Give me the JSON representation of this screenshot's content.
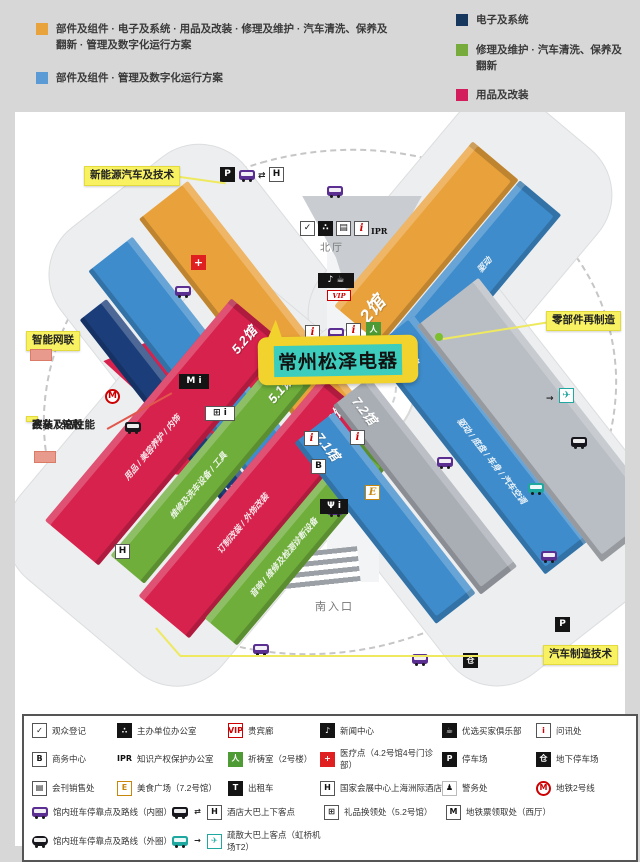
{
  "top_legend": {
    "items": [
      {
        "color": "#E8A33D",
        "text": "部件及组件 · 电子及系统 · 用品及改装 · 修理及维护 · 汽车清洗、保养及翻新 · 管理及数字化运行方案"
      },
      {
        "color": "#5B9BD5",
        "text": "部件及组件 · 管理及数字化运行方案"
      },
      {
        "color": "#17375E",
        "text": "电子及系统"
      },
      {
        "color": "#77AC3C",
        "text": "修理及维护 · 汽车清洗、保养及翻新"
      },
      {
        "color": "#D31C5B",
        "text": "用品及改装"
      }
    ]
  },
  "map": {
    "halls": [
      {
        "label": "4.2馆",
        "color": "#3E8CCB"
      },
      {
        "label": "4.1馆",
        "color": "#1B3E7A"
      },
      {
        "label": "3馆",
        "color": "#E9A23B"
      },
      {
        "label": "2馆",
        "color": "#E9A23B"
      },
      {
        "label": "1馆",
        "color": "#3E8CCB",
        "side": "驱动"
      },
      {
        "label": "5.2馆",
        "color": "#D6224C",
        "side": "用品 / 美容养护 / 内饰"
      },
      {
        "label": "5.1馆",
        "color": "#6FAE3B",
        "side": "维修及洗车设备 / 工具"
      },
      {
        "label": "6.2馆",
        "color": "#D6224C",
        "side": "订制改装 / 外饰改装"
      },
      {
        "label": "6.1馆",
        "color": "#6FAE3B",
        "side": "音响 / 维修及检测诊断设备"
      },
      {
        "label": "7.1馆",
        "color": "#3E8CCB"
      },
      {
        "label": "7.2馆",
        "color": "#A9AEB5"
      },
      {
        "label": "8.1馆",
        "color": "#3E8CCB",
        "side": "驱动 / 底盘 / 车身 / 汽车空调"
      },
      {
        "label": "",
        "color": "#B9BEC4"
      }
    ],
    "areas": {
      "west_hall": "西厅",
      "north_hall": "北厅",
      "south_entrance": "南入口"
    },
    "callouts": {
      "new_energy": "新能源汽车及技术",
      "parts_reman": "零部件再制造",
      "smart_connect": "智能网联",
      "racing_line1": "赛车及高性能",
      "racing_line2": "改装 / 轮毂",
      "manufacturing": "汽车制造技术"
    },
    "highlight": {
      "text": "常州松泽电器",
      "bubble_color": "#F2D22C",
      "text_bg": "#3CCDBD"
    }
  },
  "glyphs": {
    "parking": "P",
    "hotel": "H",
    "swap": "⇄",
    "medical": "+",
    "business": "B",
    "info": "i",
    "ipr": "IPR",
    "vip": "VIP",
    "media": "♪ ☕",
    "registration": "✓",
    "organizer": "∴",
    "directory": "▤",
    "prayer": "人",
    "metro": "M",
    "warehouse": "仓",
    "plane": "✈",
    "food_court": "E",
    "restaurant": "Ψ i",
    "metro_ticket": "M i",
    "gift": "⊞ i",
    "arrow": "→"
  },
  "bottom_legend": {
    "rows": [
      [
        {
          "icon": "reg",
          "label": "观众登记"
        },
        {
          "icon": "org",
          "label": "主办单位办公室"
        },
        {
          "icon": "vip",
          "label": "贵宾廊"
        },
        {
          "icon": "news",
          "label": "新闻中心"
        },
        {
          "icon": "buyers",
          "label": "优选买家俱乐部"
        },
        {
          "icon": "info",
          "label": "问讯处"
        }
      ],
      [
        {
          "icon": "biz",
          "label": "商务中心"
        },
        {
          "icon": "ipr",
          "label": "知识产权保护办公室"
        },
        {
          "icon": "prayer",
          "label": "祈祷室（2号楼）"
        },
        {
          "icon": "medical",
          "label": "医疗点（4.2号馆4号门诊部）"
        },
        {
          "icon": "parking",
          "label": "停车场"
        },
        {
          "icon": "ugparking",
          "label": "地下停车场"
        }
      ],
      [
        {
          "icon": "directory",
          "label": "会刊销售处"
        },
        {
          "icon": "food",
          "label": "美食广场（7.2号馆）"
        },
        {
          "icon": "taxi",
          "label": "出租车"
        },
        {
          "icon": "hotel",
          "label": "国家会展中心上海洲际酒店"
        },
        {
          "icon": "police",
          "label": "警务处"
        },
        {
          "icon": "metro",
          "label": "地铁2号线"
        }
      ],
      [
        {
          "icon": "businner",
          "label": "馆内班车停靠点及路线（内圈）"
        },
        {
          "icon": "hotelshuttle",
          "label": "酒店大巴上下客点"
        },
        {
          "icon": "gift",
          "label": "礼品换领处（5.2号馆）"
        },
        {
          "icon": "mticket",
          "label": "地铁票领取处（西厅）"
        }
      ],
      [
        {
          "icon": "busouter",
          "label": "馆内班车停靠点及路线（外圈）"
        },
        {
          "icon": "airshuttle",
          "label": "疏散大巴上客点（虹桥机场T2）"
        }
      ]
    ]
  },
  "icon_styles": {
    "reg": {
      "cls": "i-wht",
      "g": "✓"
    },
    "org": {
      "cls": "i-blk",
      "g": "∴"
    },
    "vip": {
      "cls": "i-vip",
      "g": "VIP"
    },
    "news": {
      "cls": "i-blk",
      "g": "♪"
    },
    "buyers": {
      "cls": "i-blk",
      "g": "☕"
    },
    "info": {
      "cls": "i-info",
      "g": "i"
    },
    "biz": {
      "cls": "i-wht",
      "g": "B"
    },
    "ipr": {
      "cls": "i-iprtxt",
      "g": "IPR"
    },
    "prayer": {
      "cls": "i-green",
      "g": "人"
    },
    "medical": {
      "cls": "i-red",
      "g": "+"
    },
    "parking": {
      "cls": "i-blk",
      "g": "P"
    },
    "ugparking": {
      "cls": "i-blk",
      "g": "仓"
    },
    "directory": {
      "cls": "i-wht",
      "g": "▤"
    },
    "food": {
      "cls": "i-food",
      "g": "E"
    },
    "taxi": {
      "cls": "i-blk",
      "g": "T"
    },
    "hotel": {
      "cls": "i-wht",
      "g": "H"
    },
    "police": {
      "cls": "i-pol",
      "g": "♟"
    },
    "metro": {
      "cls": "i-metro",
      "g": "M"
    },
    "businner": {
      "cls": "i-bus bus-purple",
      "g": ""
    },
    "busouter": {
      "cls": "i-bus bus-blk rounded",
      "g": ""
    },
    "busblk": {
      "cls": "i-bus bus-blk",
      "g": ""
    },
    "busteal": {
      "cls": "i-bus bus-teal",
      "g": ""
    },
    "swap": {
      "cls": "i-plain",
      "g": "⇄"
    },
    "arrow": {
      "cls": "i-plain",
      "g": "→"
    },
    "plane": {
      "cls": "i-plane",
      "g": "✈"
    },
    "gift": {
      "cls": "i-wht",
      "g": "⊞"
    },
    "mticket": {
      "cls": "i-wht",
      "g": "M"
    },
    "hotelshuttle": {
      "parts": [
        "busblk",
        "swap",
        "hotel"
      ]
    },
    "airshuttle": {
      "parts": [
        "busteal",
        "arrow",
        "plane"
      ]
    }
  }
}
